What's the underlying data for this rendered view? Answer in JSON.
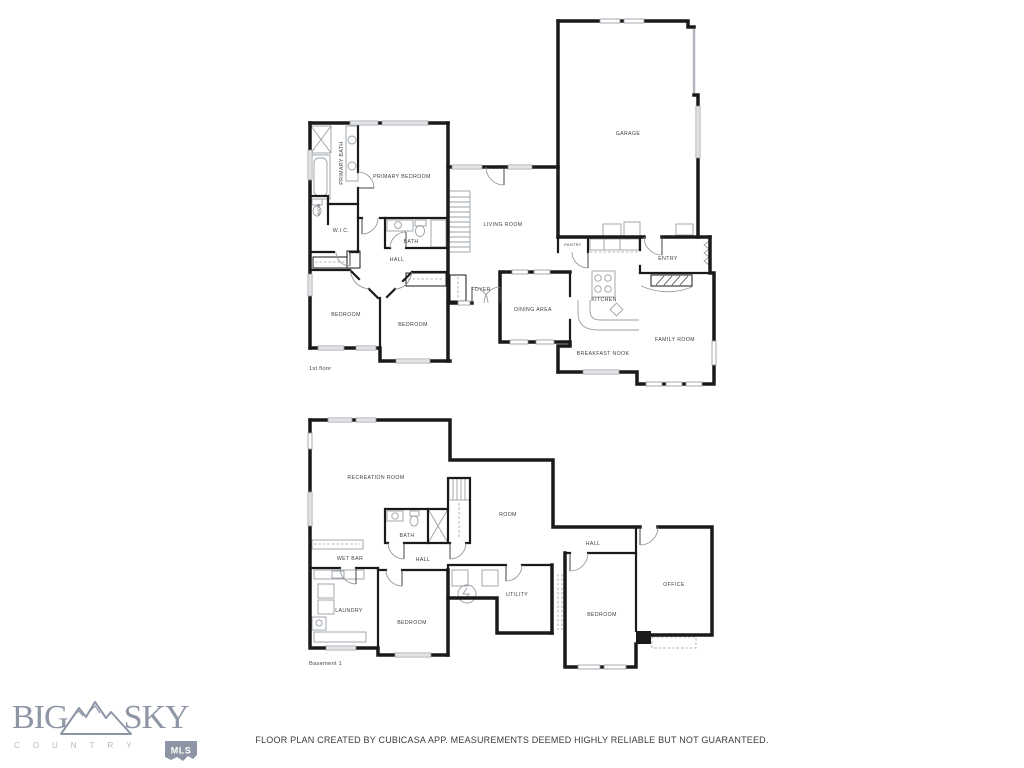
{
  "colors": {
    "wall": "#1a1a1a",
    "fixture": "#9aa0a6",
    "label": "#3f3f3f",
    "logo": "#8e96a5",
    "logo_light": "#b4bac6"
  },
  "disclaimer": "FLOOR PLAN CREATED BY CUBICASA APP. MEASUREMENTS DEEMED HIGHLY RELIABLE BUT NOT GUARANTEED.",
  "logo": {
    "word_left": "BIG",
    "word_right": "SKY",
    "tagline": "COUNTRY",
    "badge": "MLS"
  },
  "floor1": {
    "caption": "1st floor",
    "rooms": {
      "primary_bath": "PRIMARY BATH",
      "primary_bedroom": "PRIMARY BEDROOM",
      "toilet_room": "BATH",
      "wic": "W.I.C.",
      "bath": "BATH",
      "hall": "HALL",
      "bedroom_left": "BEDROOM",
      "bedroom_right": "BEDROOM",
      "foyer": "FOYER",
      "living_room": "LIVING ROOM",
      "dining_area": "DINING AREA",
      "kitchen": "KITCHEN",
      "pantry": "PANTRY",
      "entry": "ENTRY",
      "garage": "GARAGE",
      "family_room": "FAMILY ROOM",
      "breakfast_nook": "BREAKFAST NOOK"
    }
  },
  "basement": {
    "caption": "Basement 1",
    "rooms": {
      "recreation_room": "RECREATION ROOM",
      "room": "ROOM",
      "bath": "BATH",
      "wet_bar": "WET BAR",
      "hall_left": "HALL",
      "hall_right": "HALL",
      "laundry": "LAUNDRY",
      "bedroom_left": "BEDROOM",
      "utility": "UTILITY",
      "bedroom_right": "BEDROOM",
      "office": "OFFICE"
    }
  }
}
